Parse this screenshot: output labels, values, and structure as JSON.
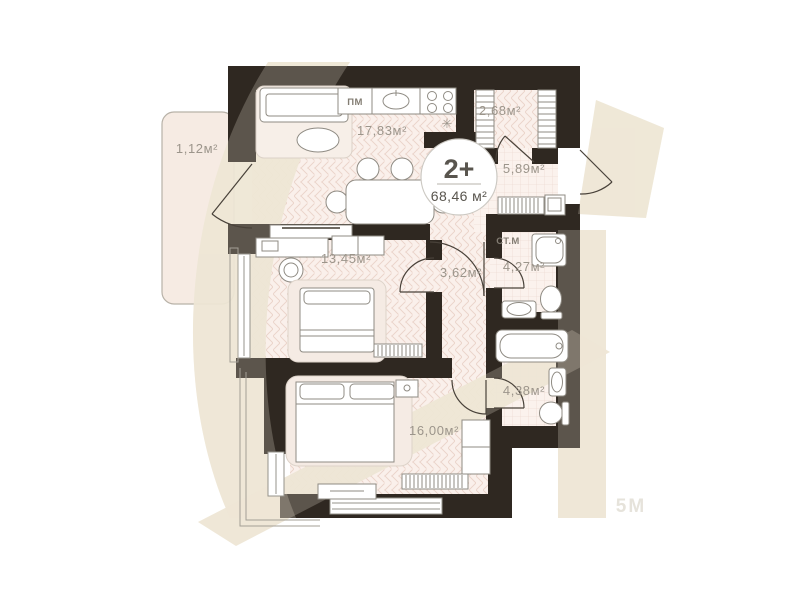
{
  "plan": {
    "title": "apartment-floor-plan",
    "badge": {
      "rooms": "2+",
      "area": "68,46 м²"
    },
    "rooms": {
      "balcony": "1,12м²",
      "living": "17,83м²",
      "closet": "2,68м²",
      "hallway": "5,89м²",
      "bedroom1": "13,45м²",
      "corridor": "3,62м²",
      "bathroom1": "4,27м²",
      "bathroom2": "4,38м²",
      "bedroom2": "16,00м²"
    },
    "markers": {
      "dishwasher": "ПМ",
      "washing_machine": "СТ.М",
      "fridge": "✳"
    },
    "watermark": {
      "brand": "5M"
    },
    "colors": {
      "wall": "#2f2821",
      "floor": "#faf0eb",
      "hatch": "#ead3c9",
      "tile_floor": "#fbf2ed",
      "watermark_beige": "#eee7d5",
      "label_gray": "#9c958b",
      "balcony_fill": "#f6ebe3"
    }
  }
}
